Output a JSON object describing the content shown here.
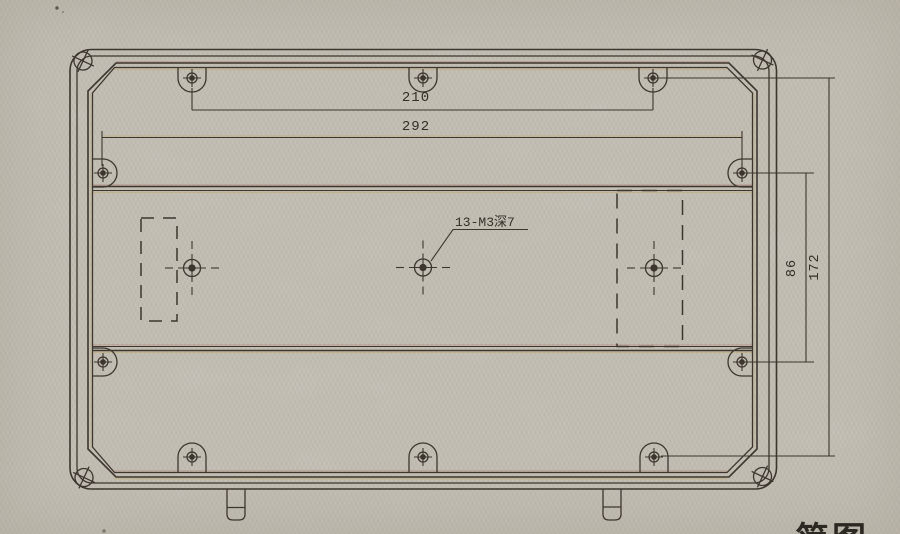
{
  "drawing": {
    "dimensions": {
      "top_hole_spacing": "210",
      "outer_hole_spacing": "292",
      "right_inner_spacing": "86",
      "right_outer_spacing": "172"
    },
    "hole_callout": "13-M3深7",
    "caption_fragment": "简图",
    "colors": {
      "paper": "#d8d4c9",
      "ink": "#3c362e"
    }
  }
}
